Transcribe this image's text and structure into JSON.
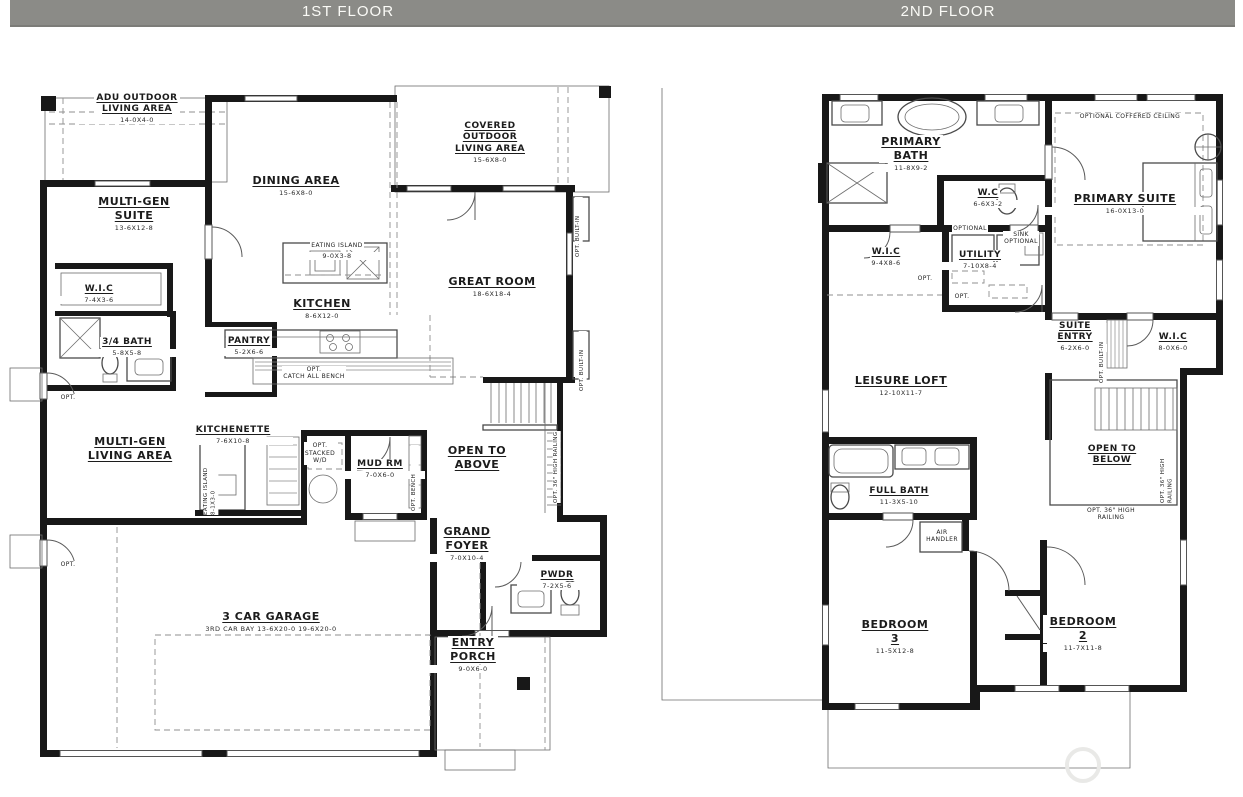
{
  "header": {
    "floor1": "1ST FLOOR",
    "floor2": "2ND FLOOR",
    "bar_color": "#8b8b87",
    "text_color": "#fbfbf7"
  },
  "palette": {
    "wall": "#181818",
    "paper": "#ffffff",
    "dash": "#8f8f8f"
  },
  "floor1": {
    "labels": {
      "adu": {
        "name": "ADU OUTDOOR\nLIVING AREA",
        "dim": "14-0X4-0"
      },
      "suite": {
        "name": "MULTI-GEN\nSUITE",
        "dim": "13-6X12-8"
      },
      "dining": {
        "name": "DINING AREA",
        "dim": "15-6X8-0"
      },
      "covered": {
        "name": "COVERED\nOUTDOOR\nLIVING AREA",
        "dim": "15-6X8-0"
      },
      "great": {
        "name": "GREAT ROOM",
        "dim": "18-6X18-4"
      },
      "island1": {
        "name": "EATING ISLAND",
        "dim": "9-0X3-8"
      },
      "kitchen": {
        "name": "KITCHEN",
        "dim": "8-6X12-0"
      },
      "wic": {
        "name": "W.I.C",
        "dim": "7-4X3-6"
      },
      "bath": {
        "name": "3/4 BATH",
        "dim": "5-8X5-8"
      },
      "pantry": {
        "name": "PANTRY",
        "dim": "5-2X6-6"
      },
      "bench_note": {
        "name": "OPT.\nCATCH ALL BENCH"
      },
      "kitchenette": {
        "name": "KITCHENETTE",
        "dim": "7-6X10-8"
      },
      "living": {
        "name": "MULTI-GEN\nLIVING AREA"
      },
      "island2": {
        "name": "EATING ISLAND",
        "dim": "8-1X3-0"
      },
      "wd_note": {
        "name": "OPT.\nSTACKED\nW/D"
      },
      "mud": {
        "name": "MUD RM",
        "dim": "7-0X6-0"
      },
      "bench_v": {
        "name": "OPT. BENCH"
      },
      "open_above": {
        "name": "OPEN TO\nABOVE"
      },
      "railing": {
        "name": "OPT. 36\" HIGH RAILING"
      },
      "foyer": {
        "name": "GRAND\nFOYER",
        "dim": "7-0X10-4"
      },
      "pwdr": {
        "name": "PWDR",
        "dim": "7-2X5-6"
      },
      "garage": {
        "name": "3 CAR GARAGE",
        "dim": "3RD CAR BAY 13-6X20-0 19-6X20-0"
      },
      "porch": {
        "name": "ENTRY\nPORCH",
        "dim": "9-0X6-0"
      },
      "builtin_a": {
        "name": "OPT. BUILT-IN"
      },
      "builtin_b": {
        "name": "OPT. BUILT-IN"
      },
      "opt1": {
        "name": "OPT."
      },
      "opt2": {
        "name": "OPT."
      }
    }
  },
  "floor2": {
    "labels": {
      "bath": {
        "name": "PRIMARY\nBATH",
        "dim": "11-8X9-2"
      },
      "wc": {
        "name": "W.C",
        "dim": "6-6X3-2"
      },
      "coffered": {
        "name": "OPTIONAL COFFERED CEILING"
      },
      "suite": {
        "name": "PRIMARY SUITE",
        "dim": "16-0X13-0"
      },
      "wic_a": {
        "name": "W.I.C",
        "dim": "9-4X8-6"
      },
      "utility": {
        "name": "UTILITY",
        "dim": "7-10X8-4"
      },
      "optional": {
        "name": "OPTIONAL"
      },
      "sink_opt": {
        "name": "SINK\nOPTIONAL"
      },
      "opt_a": {
        "name": "OPT."
      },
      "opt_b": {
        "name": "OPT."
      },
      "entry": {
        "name": "SUITE\nENTRY",
        "dim": "6-2X6-0"
      },
      "builtin": {
        "name": "OPT. BUILT-IN"
      },
      "wic_b": {
        "name": "W.I.C",
        "dim": "8-0X6-0"
      },
      "loft": {
        "name": "LEISURE LOFT",
        "dim": "12-10X11-7"
      },
      "open_below": {
        "name": "OPEN TO\nBELOW"
      },
      "railing_v": {
        "name": "OPT. 36\" HIGH RAILING"
      },
      "railing_h": {
        "name": "OPT. 36\" HIGH RAILING"
      },
      "fullbath": {
        "name": "FULL BATH",
        "dim": "11-3X5-10"
      },
      "air": {
        "name": "AIR\nHANDLER"
      },
      "bed3": {
        "name": "BEDROOM 3",
        "dim": "11-5X12-8"
      },
      "bed2": {
        "name": "BEDROOM 2",
        "dim": "11-7X11-8"
      }
    }
  }
}
